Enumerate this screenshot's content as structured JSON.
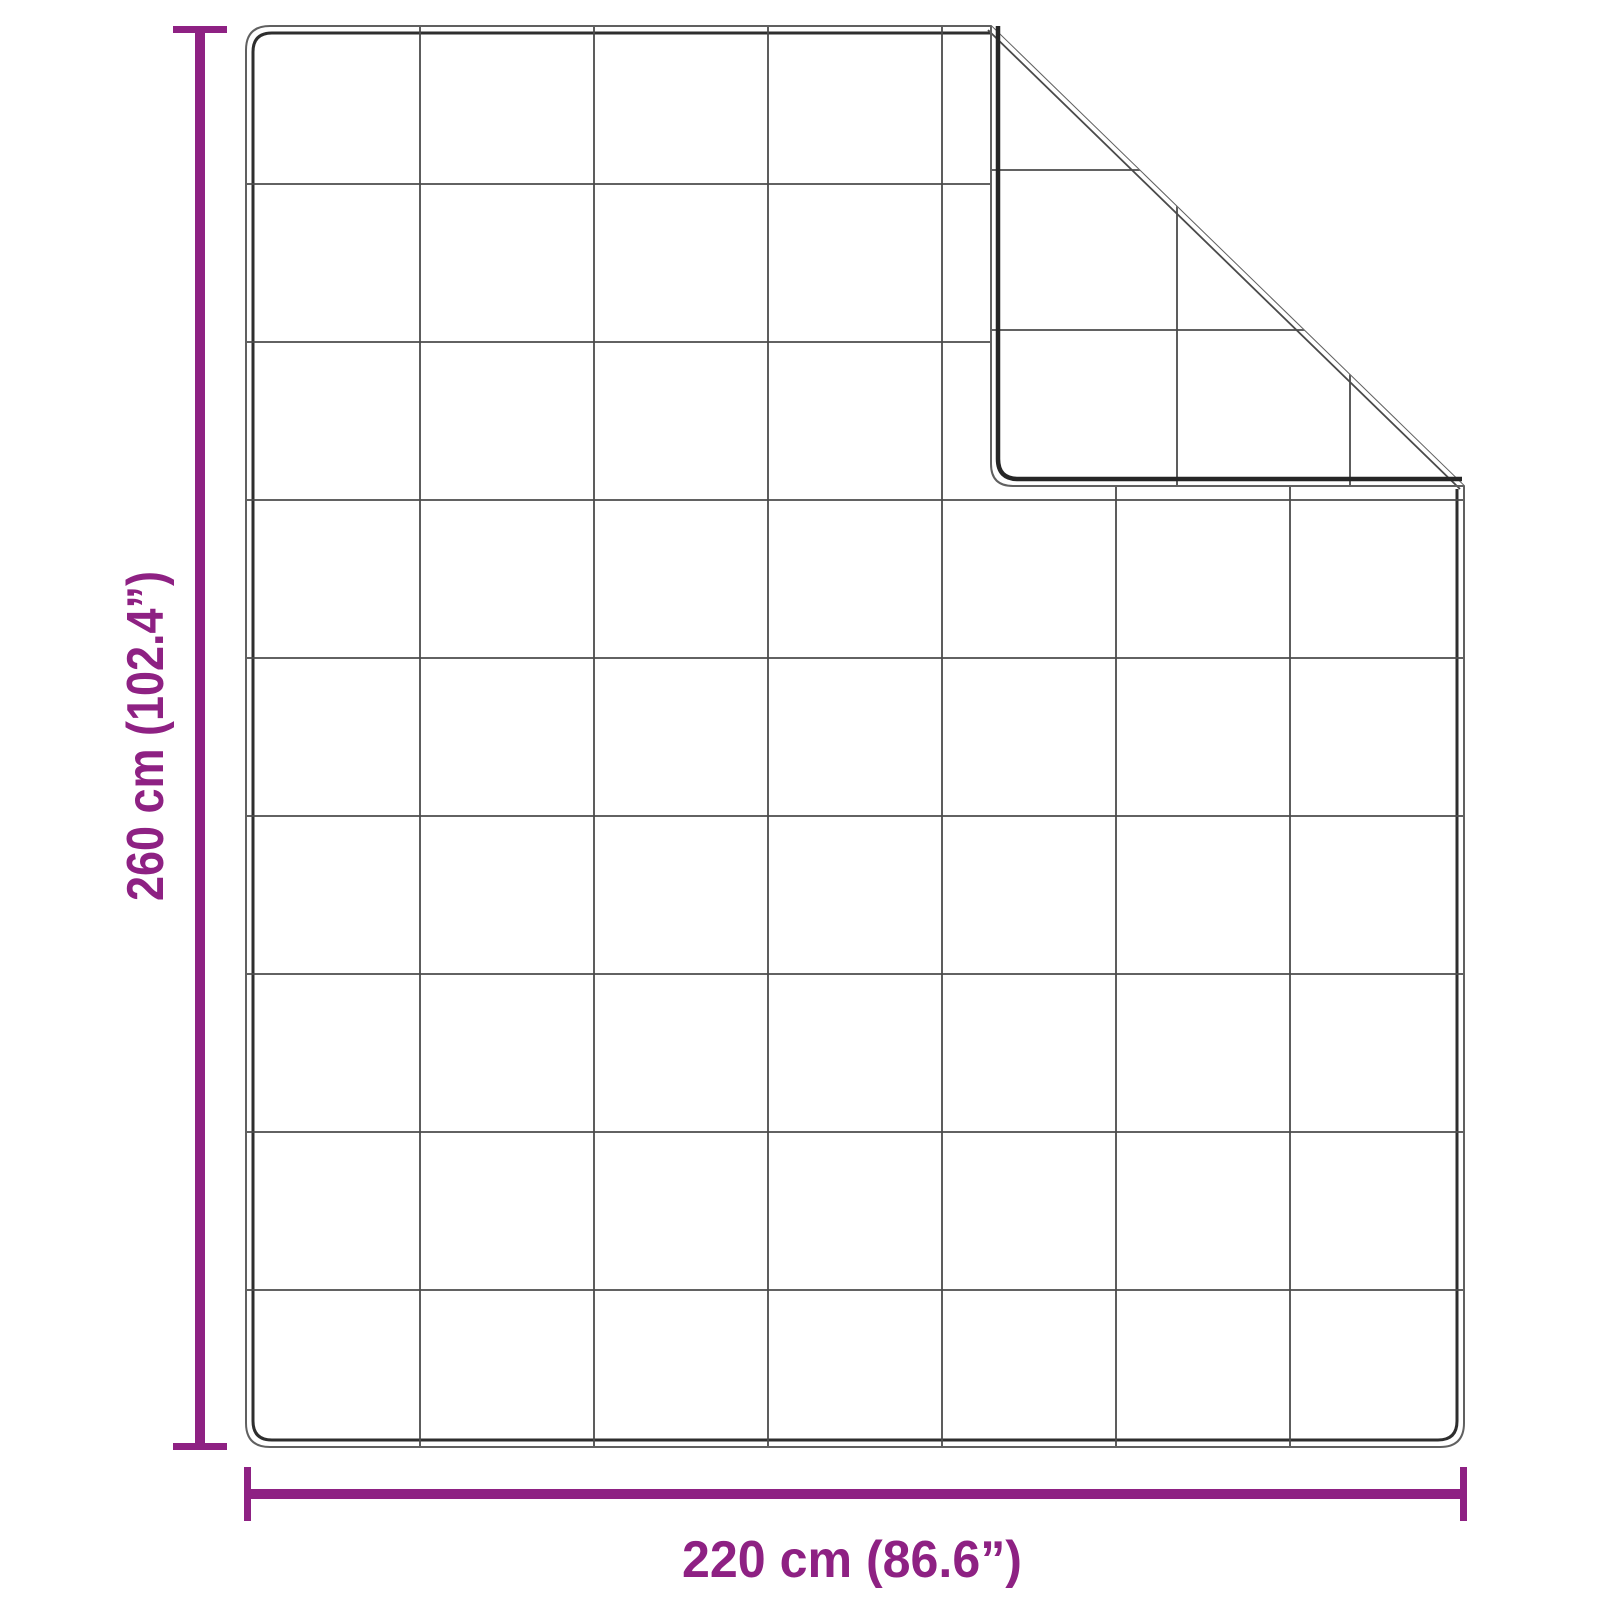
{
  "diagram": {
    "kind": "product-dimension-diagram",
    "subject": "quilted blanket shown flat with its top-right corner folded over",
    "height_dimension": {
      "label": "260 cm (102.4”)",
      "value_cm": "260 cm",
      "value_inches": "102.4”",
      "orientation": "vertical",
      "side": "left"
    },
    "width_dimension": {
      "label": "220 cm (86.6”)",
      "value_cm": "220 cm",
      "value_inches": "86.6”",
      "orientation": "horizontal",
      "side": "bottom"
    },
    "quilt_grid": {
      "columns": 7,
      "rows": 9,
      "back_side_lines_visible_on_fold": 4
    },
    "colors": {
      "accent": "#8E2183",
      "outline_light": "#606060",
      "outline_dark": "#2e2e2e",
      "grid_line": "#4b4b4b",
      "background": "#ffffff"
    }
  }
}
